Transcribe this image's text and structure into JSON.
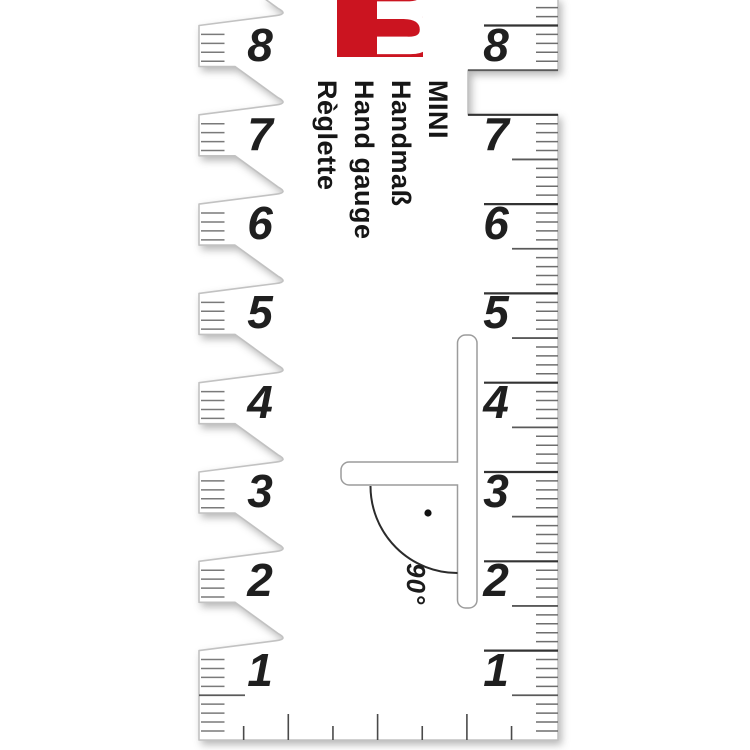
{
  "product": {
    "logo_letter": "m",
    "name_lines": [
      "MINI",
      "Handmaß",
      "Hand gauge",
      "Règlette"
    ],
    "angle_label": "90°"
  },
  "scales": {
    "left_labels": [
      "8",
      "7",
      "6",
      "5",
      "4",
      "3",
      "2",
      "1"
    ],
    "right_labels": [
      "8",
      "7",
      "6",
      "5",
      "4",
      "3",
      "2",
      "1"
    ]
  },
  "colors": {
    "logo_red": "#cb1420",
    "ink": "#1c1c1c",
    "tick_minor": "#6e6e6e",
    "tick_half": "#5a5a5a",
    "tick_cm": "#333333",
    "edge": "#c2c2c2"
  }
}
